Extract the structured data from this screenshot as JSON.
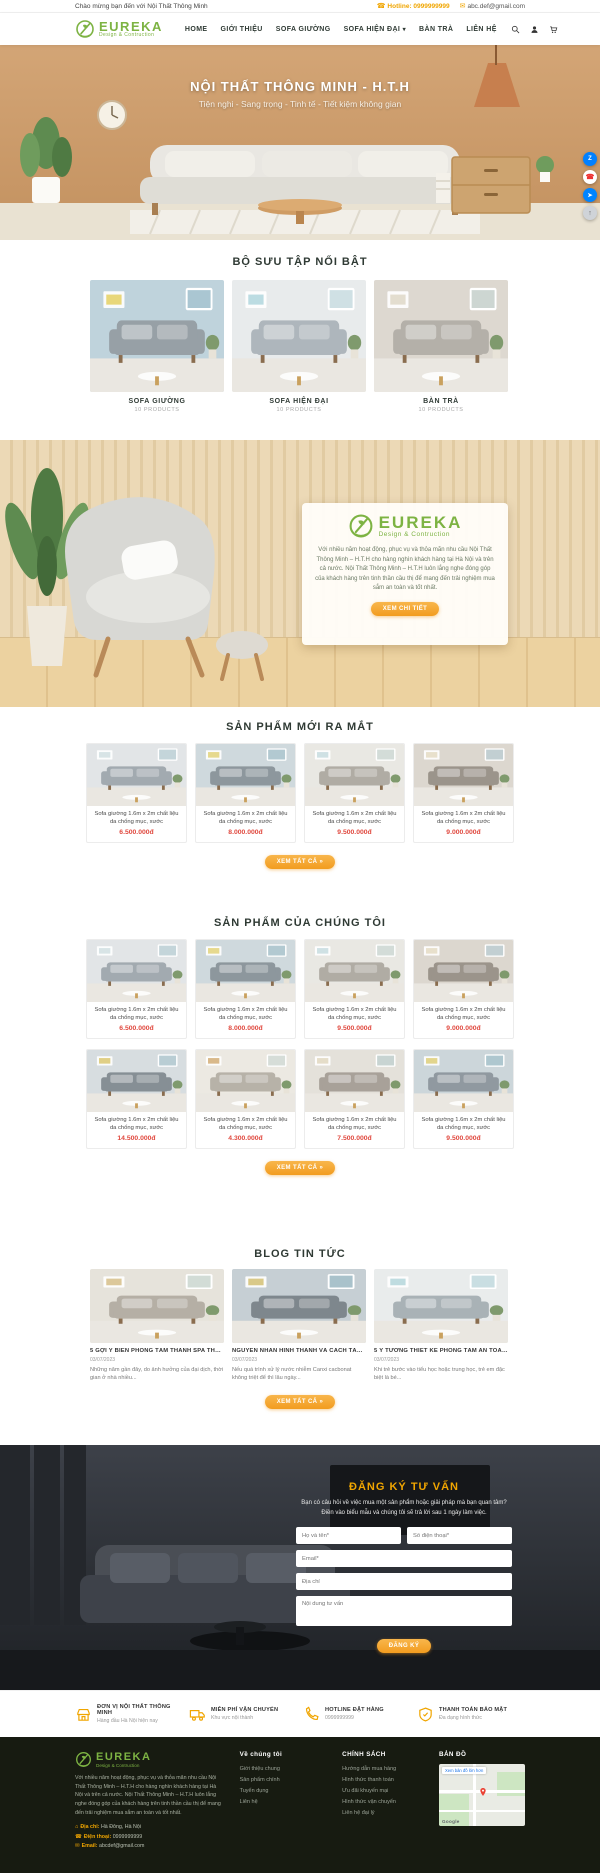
{
  "topbar": {
    "welcome": "Chào mừng bạn đến với Nội Thất Thông Minh",
    "hotline": "Hotline: 0999999999",
    "email": "abc.def@gmail.com"
  },
  "brand": {
    "title": "EUREKA",
    "subtitle": "Design & Contruction"
  },
  "nav": {
    "items": [
      {
        "label": "HOME"
      },
      {
        "label": "GIỚI THIỆU"
      },
      {
        "label": "SOFA GIƯỜNG"
      },
      {
        "label": "SOFA HIỆN ĐẠI"
      },
      {
        "label": "BÀN TRÀ"
      },
      {
        "label": "LIÊN HỆ"
      }
    ]
  },
  "hero": {
    "title": "NỘI THẤT THÔNG MINH - H.T.H",
    "subtitle": "Tiện nghi - Sang trọng - Tinh tế - Tiết kiệm không gian"
  },
  "floating_icons": [
    "zalo-icon",
    "phone-icon",
    "messenger-icon",
    "scroll-top-icon"
  ],
  "collections": {
    "heading": "BỘ SƯU TẬP NỔI BẬT",
    "items": [
      {
        "name": "SOFA GIƯỜNG",
        "count": "10 PRODUCTS"
      },
      {
        "name": "SOFA HIỆN ĐẠI",
        "count": "10 PRODUCTS"
      },
      {
        "name": "BÀN TRÀ",
        "count": "10 PRODUCTS"
      }
    ]
  },
  "about": {
    "text": "Với nhiều năm hoạt động, phục vụ và thỏa mãn nhu cầu Nội Thất Thông Minh – H.T.H cho hàng nghìn khách hàng tại Hà Nội và trên cả nước. Nội Thất Thông Minh – H.T.H luôn lắng nghe đóng góp của khách hàng trên tinh thần cầu thị để mang đến trải nghiệm mua sắm an toàn và tốt nhất.",
    "button": "XEM CHI TIẾT"
  },
  "new_products": {
    "heading": "SẢN PHẨM MỚI RA MẮT",
    "button": "XEM TẤT CẢ »",
    "items": [
      {
        "name": "Sofa giường 1.6m x 2m chất liệu da chống mục, xước",
        "price": "6.500.000đ"
      },
      {
        "name": "Sofa giường 1.6m x 2m chất liệu da chống mục, xước",
        "price": "8.000.000đ"
      },
      {
        "name": "Sofa giường 1.6m x 2m chất liệu da chống mục, xước",
        "price": "9.500.000đ"
      },
      {
        "name": "Sofa giường 1.6m x 2m chất liệu da chống mục, xước",
        "price": "9.000.000đ"
      }
    ]
  },
  "our_products": {
    "heading": "SẢN PHẨM CỦA CHÚNG TÔI",
    "button": "XEM TẤT CẢ »",
    "items": [
      {
        "name": "Sofa giường 1.6m x 2m chất liệu da chống mục, xước",
        "price": "6.500.000đ"
      },
      {
        "name": "Sofa giường 1.6m x 2m chất liệu da chống mục, xước",
        "price": "8.000.000đ"
      },
      {
        "name": "Sofa giường 1.6m x 2m chất liệu da chống mục, xước",
        "price": "9.500.000đ"
      },
      {
        "name": "Sofa giường 1.6m x 2m chất liệu da chống mục, xước",
        "price": "9.000.000đ"
      },
      {
        "name": "Sofa giường 1.6m x 2m chất liệu da chống mục, xước",
        "price": "14.500.000đ"
      },
      {
        "name": "Sofa giường 1.6m x 2m chất liệu da chống mục, xước",
        "price": "4.300.000đ"
      },
      {
        "name": "Sofa giường 1.6m x 2m chất liệu da chống mục, xước",
        "price": "7.500.000đ"
      },
      {
        "name": "Sofa giường 1.6m x 2m chất liệu da chống mục, xước",
        "price": "9.500.000đ"
      }
    ]
  },
  "blog": {
    "heading": "BLOG TIN TỨC",
    "button": "XEM TẤT CẢ »",
    "posts": [
      {
        "title": "5 GỢI Ý BIẾN PHÒNG TẮM THÀNH SPA THƯ GIÃN",
        "date": "03/07/2023",
        "excerpt": "Những năm gần đây, do ảnh hưởng của đại dịch, thời gian ở nhà nhiều..."
      },
      {
        "title": "NGUYÊN NHÂN HÌNH THÀNH VÀ CÁCH TẨY CẶN CANXI",
        "date": "03/07/2023",
        "excerpt": "Nếu quá trình xử lý nước nhiễm Canxi cacbonat không triệt để thì lâu ngày..."
      },
      {
        "title": "5 Ý TƯỞNG THIẾT KẾ PHÒNG TẮM AN TOÀN CHO TRẺ EM",
        "date": "03/07/2023",
        "excerpt": "Khi trẻ bước vào tiểu học hoặc trung học, trẻ em đặc biệt là bé..."
      }
    ]
  },
  "consult": {
    "heading": "ĐĂNG KÝ TƯ VẤN",
    "description": "Bạn có câu hỏi về việc mua một sản phẩm hoặc giải pháp mà bạn quan tâm? Điền vào biểu mẫu và chúng tôi sẽ trả lời sau 1 ngày làm việc.",
    "fields": {
      "name": "Họ và tên*",
      "phone": "Số điện thoại*",
      "email": "Email*",
      "address": "Địa chỉ",
      "content": "Nội dung tư vấn"
    },
    "button": "ĐĂNG KÝ"
  },
  "features": [
    {
      "title": "ĐƠN VỊ NỘI THẤT THÔNG MINH",
      "subtitle": "Hàng đầu Hà Nội hiện nay"
    },
    {
      "title": "MIỄN PHÍ VẬN CHUYỂN",
      "subtitle": "Khu vực nội thành"
    },
    {
      "title": "HOTLINE ĐẶT HÀNG",
      "subtitle": "0999999999"
    },
    {
      "title": "THANH TOÁN BẢO MẬT",
      "subtitle": "Đa dạng hình thức"
    }
  ],
  "footer": {
    "about": "Với nhiều năm hoạt động, phục vụ và thỏa mãn nhu cầu Nội Thất Thông Minh – H.T.H cho hàng nghìn khách hàng tại Hà Nội và trên cả nước. Nội Thất Thông Minh – H.T.H luôn lắng nghe đóng góp của khách hàng trên tinh thần cầu thị để mang đến trải nghiệm mua sắm an toàn và tốt nhất.",
    "contact": {
      "address_label": "Địa chỉ:",
      "address": "Hà Đông, Hà Nội",
      "phone_label": "Điện thoại:",
      "phone": "0999999999",
      "email_label": "Email:",
      "email": "abcdef@gmail.com"
    },
    "col_about": {
      "title": "Về chúng tôi",
      "links": [
        "Giới thiệu chung",
        "Sản phẩm chính",
        "Tuyển dụng",
        "Liên hệ"
      ]
    },
    "col_policy": {
      "title": "CHÍNH SÁCH",
      "links": [
        "Hướng dẫn mua hàng",
        "Hình thức thanh toán",
        "Ưu đãi khuyến mại",
        "Hình thức vận chuyển",
        "Liên hệ đại lý"
      ]
    },
    "col_map": {
      "title": "BẢN ĐỒ",
      "map_link": "Xem bản đồ lớn hơn",
      "map_brand": "Google"
    }
  },
  "colors": {
    "brand_green": "#7db343",
    "accent_orange": "#f5a623",
    "price_red": "#e0483e",
    "footer_bg": "#171b11"
  }
}
